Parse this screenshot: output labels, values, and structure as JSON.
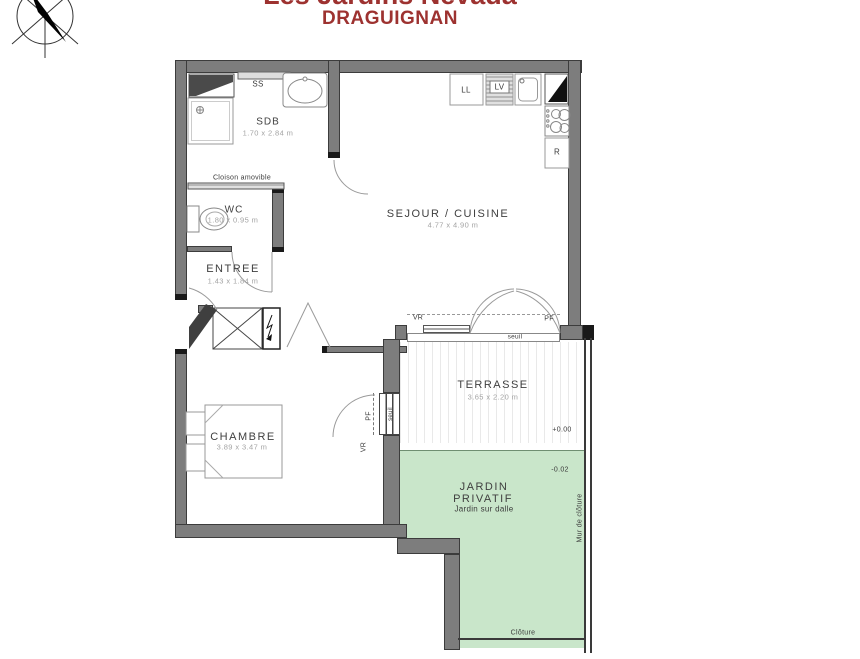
{
  "header": {
    "project": "Les Jardins Nevada",
    "city": "DRAGUIGNAN"
  },
  "rooms": {
    "sdb": {
      "name": "SDB",
      "dims": "1.70 x 2.84 m"
    },
    "wc": {
      "name": "WC",
      "dims": "1.80 x 0.95 m"
    },
    "entree": {
      "name": "ENTREE",
      "dims": "1.43 x 1.84 m"
    },
    "sejour": {
      "name": "SEJOUR / CUISINE",
      "dims": "4.77 x 4.90 m"
    },
    "chambre": {
      "name": "CHAMBRE",
      "dims": "3.89 x 3.47 m"
    },
    "terrasse": {
      "name": "TERRASSE",
      "dims": "3.65 x 2.20 m"
    },
    "jardin": {
      "name_line1": "JARDIN",
      "name_line2": "PRIVATIF",
      "subtitle": "Jardin sur dalle"
    }
  },
  "equipment": {
    "towel_dryer": "SS",
    "washer": "LL",
    "dishwasher": "LV",
    "fridge": "R"
  },
  "openings": {
    "partition": "Cloison amovible",
    "sejour_vr": "VR",
    "sejour_pf": "PF",
    "sejour_seuil": "seuil",
    "chambre_pf": "PF",
    "chambre_seuil": "seuil",
    "chambre_vr": "VR"
  },
  "levels": {
    "terrace": "+0.00",
    "garden": "-0.02"
  },
  "boundaries": {
    "wall": "Mur de clôture",
    "fence": "Clôture"
  },
  "colors": {
    "title": "#9d3230",
    "wall": "#7d7d7d",
    "wall_dark": "#3c3c3c",
    "garden": "#c9e6ca",
    "label": "#3f3f3f",
    "dims": "#a3a3a3"
  }
}
